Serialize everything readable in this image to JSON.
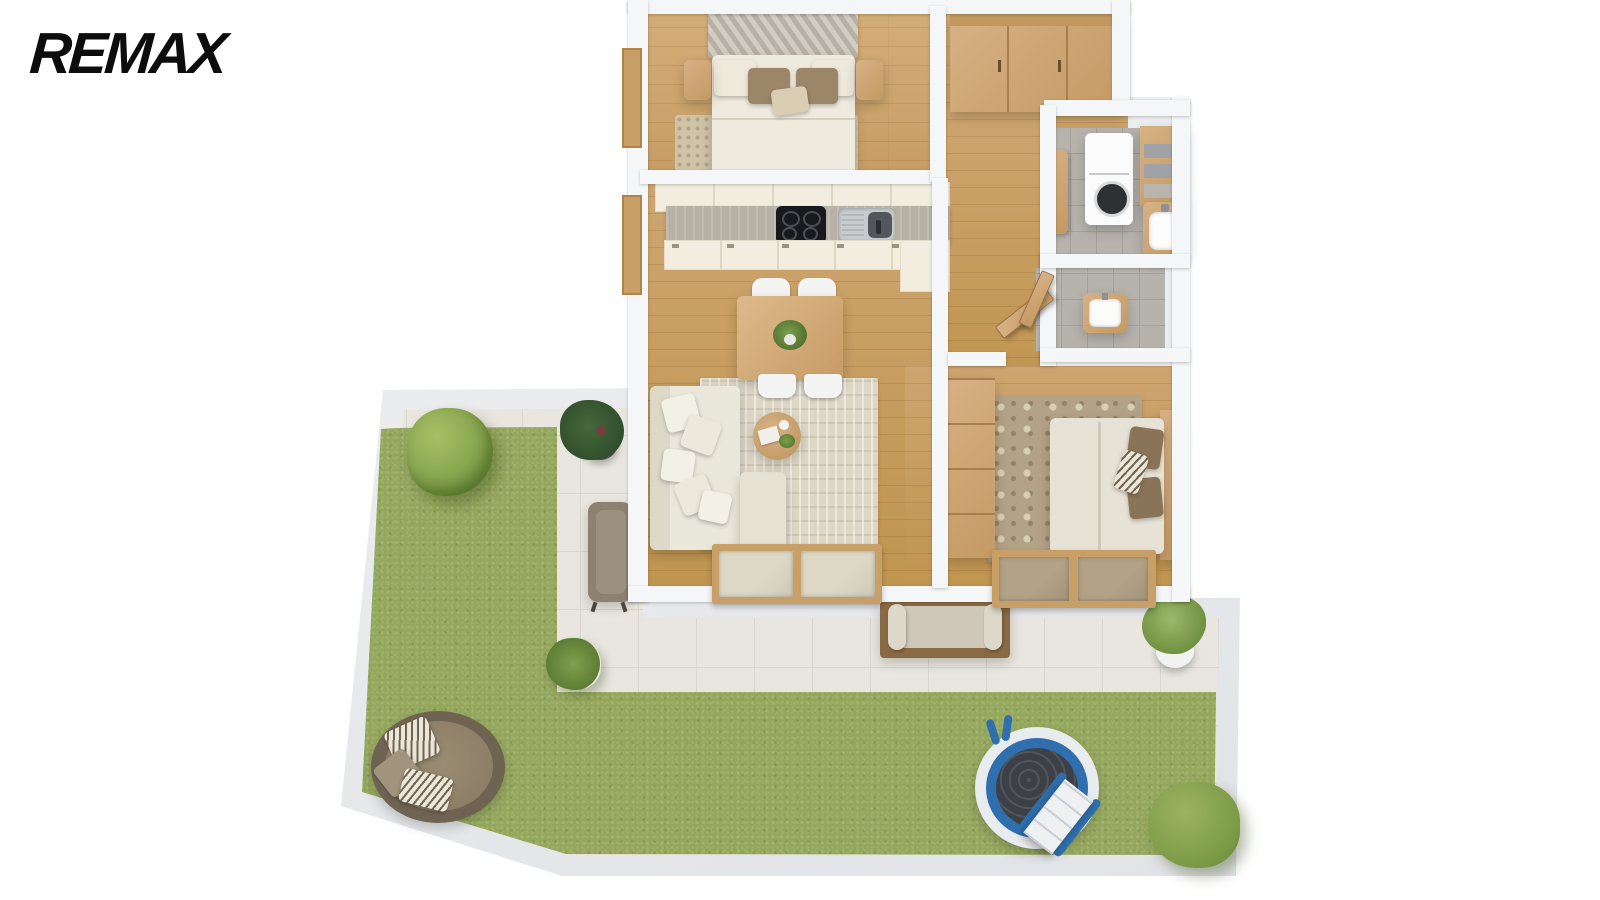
{
  "brand": {
    "logo_text": "REMAX",
    "logo_color": "#0d0d0d"
  },
  "palette": {
    "background": "#ffffff",
    "wall": "#f5f6f8",
    "wall_shadow": "#dcdfe3",
    "wood_floor": "#cfa873",
    "wood_furniture": "#c9a06a",
    "kitchen_cabinet_cream": "#f2edde",
    "countertop": "#b8b2a6",
    "cooktop_black": "#17191c",
    "grass_green": "#94a75f",
    "patio_tile": "#e9e6df",
    "bathroom_tile_gray": "#b6b2ac",
    "sofa_cream": "#eae7db",
    "rug_cream": "#ddd7c6",
    "rug_floral": "#b2a287",
    "rug_bedroom": "#cfc3a8",
    "pool_blue": "#2f6fae",
    "pool_water": "#3d4147",
    "daybed_brown": "#80745f",
    "pillow_brown": "#9b8668"
  },
  "floorplan": {
    "view": "3d-top-down-render",
    "rooms": [
      {
        "name": "bedroom-1",
        "floor": "wood",
        "furniture": [
          "double-bed",
          "chevron-headboard",
          "pillows",
          "nightstand-left",
          "nightstand-right",
          "area-rug"
        ]
      },
      {
        "name": "walk-in-closet",
        "floor": "wood",
        "furniture": [
          "wardrobe"
        ]
      },
      {
        "name": "laundry-room",
        "floor": "gray-tile",
        "furniture": [
          "washing-machine",
          "shelving-unit",
          "side-cabinet",
          "vanity-sink"
        ]
      },
      {
        "name": "kitchen",
        "floor": "wood",
        "furniture": [
          "upper-cabinets",
          "countertop",
          "cooktop",
          "sink",
          "lower-cabinets",
          "tall-cabinet"
        ]
      },
      {
        "name": "living-dining-room",
        "floor": "wood",
        "furniture": [
          "dining-table",
          "dining-chairs",
          "centerpiece-plant",
          "corner-sofa",
          "throw-pillows",
          "coffee-table",
          "area-rug"
        ]
      },
      {
        "name": "wc",
        "floor": "gray-tile",
        "furniture": [
          "vanity-sink",
          "door"
        ]
      },
      {
        "name": "hallway",
        "floor": "wood",
        "furniture": [
          "door"
        ]
      },
      {
        "name": "bedroom-2",
        "floor": "wood",
        "furniture": [
          "double-bed",
          "pillows",
          "wood-headboard",
          "floral-rug",
          "dresser",
          "tv"
        ]
      }
    ],
    "outdoor": {
      "areas": [
        "lawn",
        "paved-patio",
        "perimeter-wall"
      ],
      "items": [
        "round-daybed",
        "striped-pillows",
        "above-ground-pool",
        "pool-steps",
        "garden-bench",
        "outdoor-armchair",
        "large-bush",
        "small-bush",
        "palm-plant",
        "potted-plant-dark",
        "potted-plant-white-pot"
      ]
    },
    "openings": [
      "sliding-glass-door-living",
      "window-bedroom-2",
      "window-left-bedroom-1",
      "window-left-living",
      "interior-doors"
    ]
  }
}
